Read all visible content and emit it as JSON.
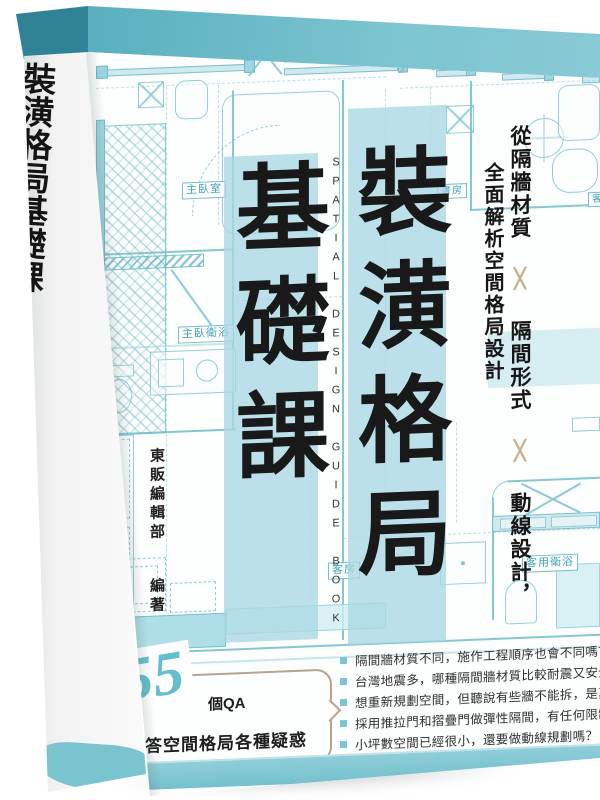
{
  "book": {
    "spine": {
      "title": "裝潢格局基礎課",
      "subtitle_en": "SPATIAL DESIGN GUIDE BOOK",
      "author_name": "東販編輯部",
      "author_role": "編著",
      "publisher": "東販出版"
    },
    "cover": {
      "title_column_right": "裝潢格局",
      "title_column_left": "基礎課",
      "title_full": "裝潢格局基礎課",
      "subtitle_en": "SPATIAL DESIGN GUIDE BOOK",
      "tagline": {
        "segment_1": "從隔牆材質",
        "separator": "╳",
        "segment_2": "隔間形式",
        "segment_3": "動線設計，",
        "line_2": "全面解析空間格局設計"
      },
      "author_name": "東販編輯部",
      "author_role": "編著",
      "badge": {
        "number": "55",
        "unit": "個QA",
        "caption": "解答空間格局各種疑惑"
      },
      "questions": [
        "隔間牆材質不同，施作工程順序也會不同嗎？",
        "台灣地震多，哪種隔間牆材質比較耐震又安全？",
        "想重新規劃空間，但聽說有些牆不能拆，是真的嗎？",
        "採用推拉門和摺疊門做彈性隔間，有任何限制嗎？",
        "小坪數空間已經很小，還要做動線規劃嗎？"
      ],
      "floorplan": {
        "labels": {
          "master_bedroom": "主臥室",
          "master_bath": "主臥衛浴",
          "study": "書房",
          "living_partial": "客",
          "guest_room": "客房",
          "guest_bath": "客用衛浴"
        },
        "annotations": {
          "a": "A",
          "c": "C"
        }
      }
    },
    "colors": {
      "top_edge": "#5bb3c2",
      "top_edge_dark": "#3e96a8",
      "bottom_strip": "#7fc7d2",
      "title_overlay": "#a8d7e3",
      "plan_line": "#71bdca",
      "badge_number": "#63bfcd",
      "badge_border": "#b7a48f",
      "cross_mark": "#c4b08d",
      "text_dark": "#191919"
    }
  }
}
